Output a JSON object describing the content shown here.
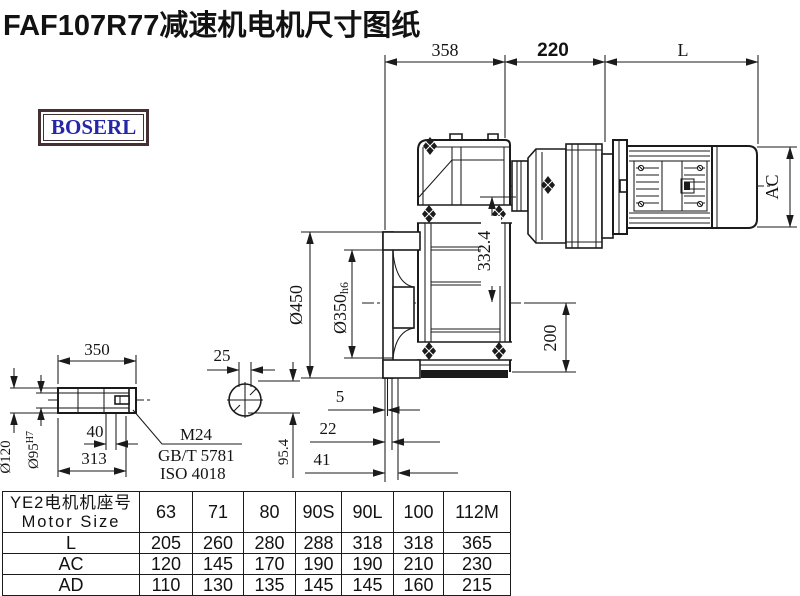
{
  "title": "FAF107R77减速机电机尺寸图纸",
  "logo": {
    "text": "BOSERL"
  },
  "colors": {
    "line": "#1b1b1b",
    "logo_text": "#2527a6",
    "logo_border": "#453134",
    "background": "#ffffff"
  },
  "dims": {
    "top1": "358",
    "top2": "220",
    "top3": "L",
    "ac": "AC",
    "flange_od": "Ø450",
    "spigot": "Ø350",
    "spigot_tol": "h6",
    "center_height": "332.4",
    "base_height": "200",
    "off1": "5",
    "off2": "22",
    "off3": "41",
    "shaft_len": "350",
    "key_w": "25",
    "bore_len": "40",
    "hub_len": "313",
    "shaft_od": "Ø120",
    "bore": "Ø95",
    "bore_tol": "H7",
    "key_depth": "95.4",
    "thread": "M24",
    "std1": "GB/T 5781",
    "std2": "ISO 4018"
  },
  "table": {
    "header_cn": "YE2电机机座号",
    "header_en": "Motor Size",
    "columns": [
      "63",
      "71",
      "80",
      "90S",
      "90L",
      "100",
      "112M"
    ],
    "rows": [
      {
        "label": "L",
        "values": [
          "205",
          "260",
          "280",
          "288",
          "318",
          "318",
          "365"
        ]
      },
      {
        "label": "AC",
        "values": [
          "120",
          "145",
          "170",
          "190",
          "190",
          "210",
          "230"
        ]
      },
      {
        "label": "AD",
        "values": [
          "110",
          "130",
          "135",
          "145",
          "145",
          "160",
          "215"
        ]
      }
    ]
  }
}
